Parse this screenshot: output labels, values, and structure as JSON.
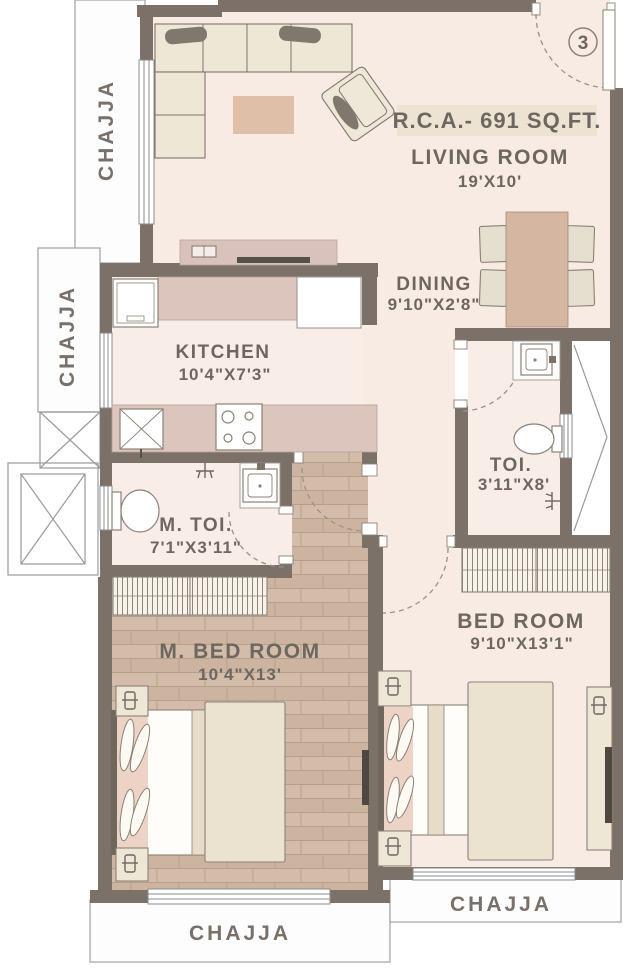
{
  "unit": {
    "number": "3"
  },
  "area": {
    "label": "R.C.A.- 691 SQ.FT."
  },
  "rooms": {
    "living": {
      "name": "LIVING ROOM",
      "dims": "19'X10'"
    },
    "dining": {
      "name": "DINING",
      "dims": "9'10\"X2'8\""
    },
    "kitchen": {
      "name": "KITCHEN",
      "dims": "10'4\"X7'3\""
    },
    "toilet": {
      "name": "TOI.",
      "dims": "3'11\"X8'"
    },
    "master_toilet": {
      "name": "M. TOI.",
      "dims": "7'1\"X3'11\""
    },
    "master_bedroom": {
      "name": "M. BED ROOM",
      "dims": "10'4\"X13'"
    },
    "bedroom": {
      "name": "BED ROOM",
      "dims": "9'10\"X13'1\""
    }
  },
  "chajja": {
    "top_left": "CHAJJA",
    "mid_left": "CHAJJA",
    "bottom_center": "CHAJJA",
    "bottom_right": "CHAJJA"
  },
  "colors": {
    "wall": "#7b7168",
    "floor_pink": "#f8ebe4",
    "wood": "#d2bba8",
    "counter_mauve": "#dcc5bd",
    "furniture_cream": "#efe7d6",
    "duvet": "#ebe2d0",
    "rug": "#e0bfa9",
    "table": "#d5b6a1",
    "label_text": "#6d6760",
    "highlight_bg": "#ece3d3",
    "dark_accent": "#4e4841"
  }
}
